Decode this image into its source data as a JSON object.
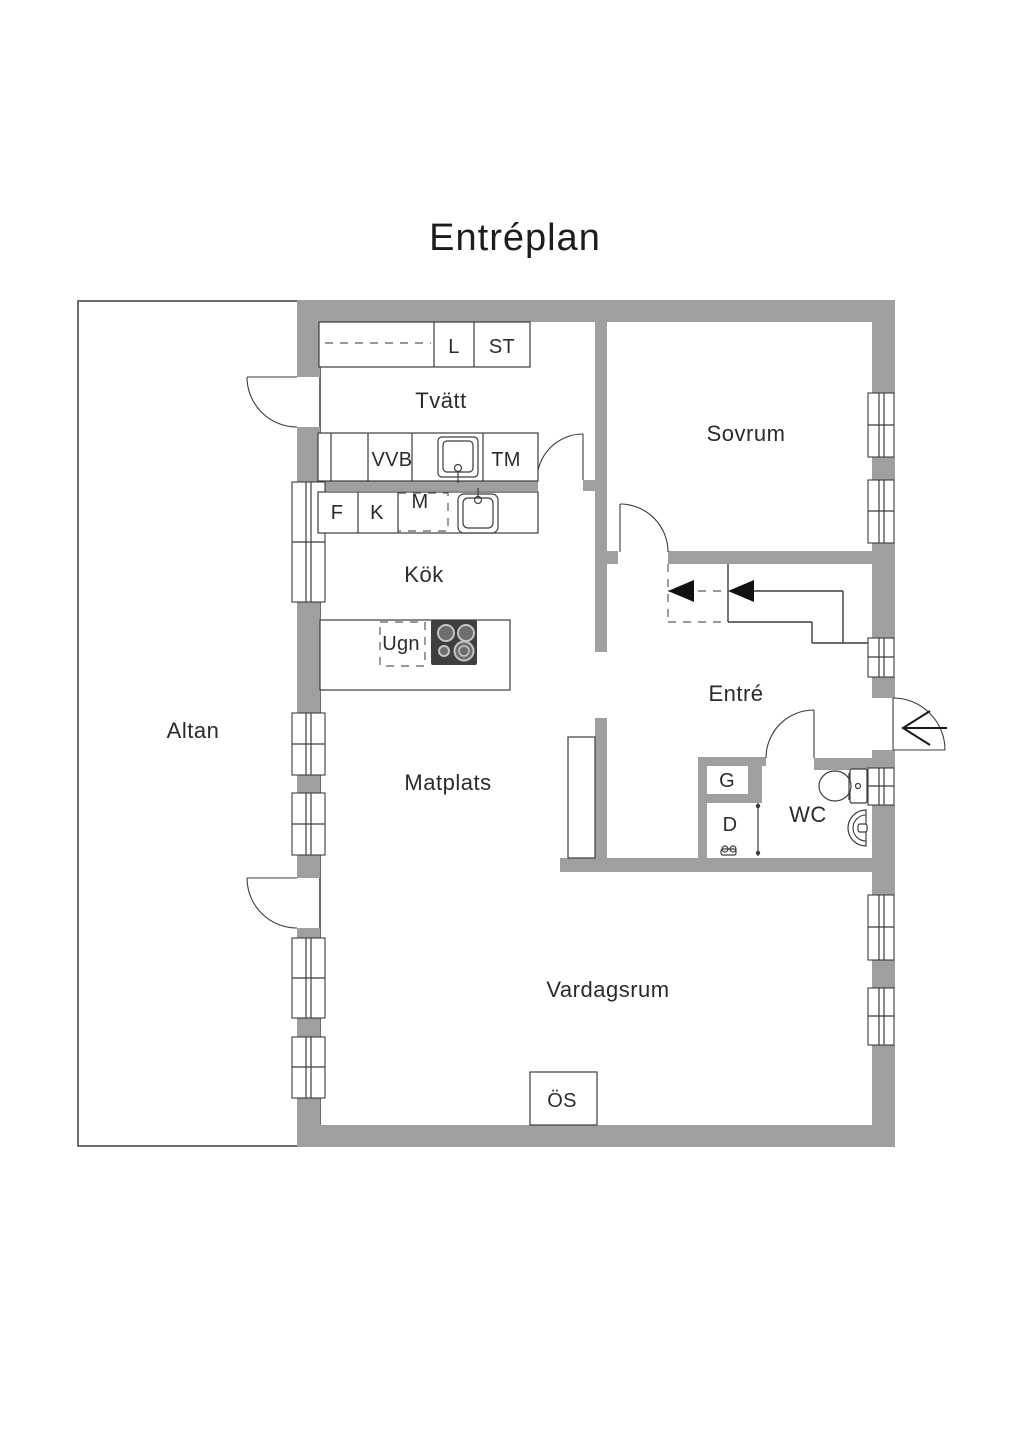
{
  "title": "Entréplan",
  "rooms": {
    "tvatt": "Tvätt",
    "sovrum": "Sovrum",
    "kok": "Kök",
    "altan": "Altan",
    "entre": "Entré",
    "matplats": "Matplats",
    "wc": "WC",
    "vardagsrum": "Vardagsrum"
  },
  "labels": {
    "l": "L",
    "st": "ST",
    "vvb": "VVB",
    "tm": "TM",
    "m": "M",
    "f": "F",
    "k": "K",
    "ugn": "Ugn",
    "g": "G",
    "d": "D",
    "os": "ÖS"
  },
  "fixtures": [
    "laundry-sink",
    "kitchen-sink",
    "stove",
    "oven-dashed",
    "toilet",
    "wash-basin",
    "shower-screen",
    "shower-mixer",
    "fireplace",
    "stairs",
    "wardrobe",
    "upper-cabinets"
  ],
  "colors": {
    "wall": "#9f9f9f",
    "line": "#3c3c3c",
    "text": "#2b2b2b",
    "background": "#ffffff"
  }
}
